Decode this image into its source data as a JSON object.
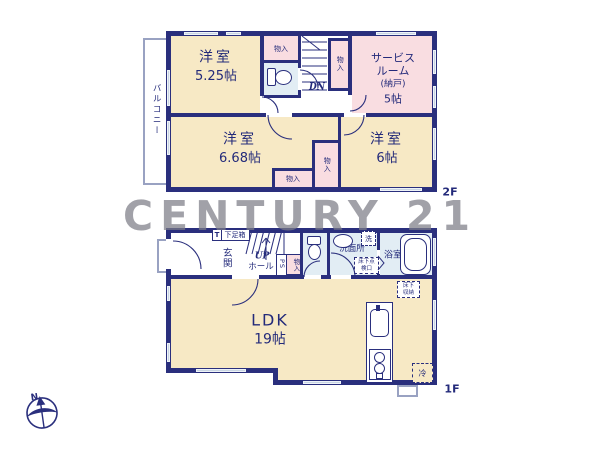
{
  "watermark": "CENTURY 21",
  "compass": {
    "north": "N"
  },
  "floor_2f": {
    "floor_label": "2F",
    "balcony": "バルコニー",
    "room1_name": "洋室",
    "room1_size": "5.25帖",
    "service_line1": "サービス",
    "service_line2": "ルーム",
    "service_line3": "(納戸)",
    "service_line4": "5帖",
    "room2_name": "洋室",
    "room2_size": "6.68帖",
    "room3_name": "洋室",
    "room3_size": "6帖",
    "closet_top": "物入",
    "closet_service": "物入",
    "closet_mid": "物入",
    "closet_bottom": "物入",
    "stairs_down": "DN"
  },
  "floor_1f": {
    "floor_label": "1F",
    "genkan": "玄関",
    "shoebox_t": "T",
    "shoebox": "下足箱",
    "stairs_up": "UP",
    "hall": "ホール",
    "ps": "PS",
    "closet": "物入",
    "washroom": "洗面所",
    "laundry": "洗",
    "underfloor_hatch": "床下点検口",
    "bath": "浴室",
    "underfloor_storage": "床下収納",
    "ldk_name": "LDK",
    "ldk_size": "19帖",
    "fridge": "冷"
  },
  "colors": {
    "wall": "#2a2f7d",
    "room_cream": "#f7e9c5",
    "room_pink": "#f9dde1",
    "room_blue": "#e2edf4",
    "window": "#c9d5e3",
    "text": "#232a7a",
    "watermark_gray": "#7d7d86"
  }
}
